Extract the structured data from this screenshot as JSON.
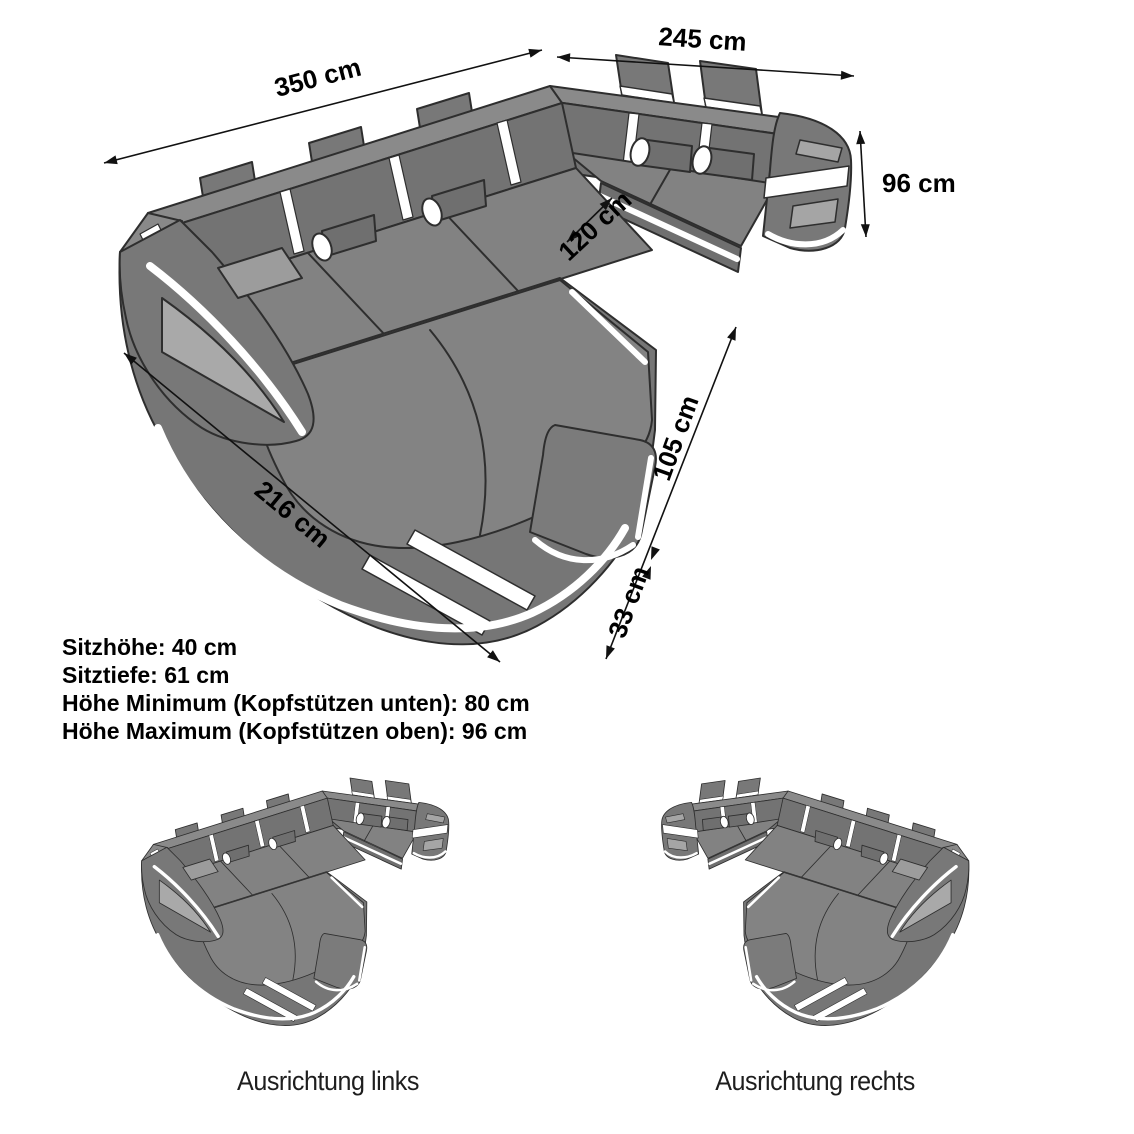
{
  "diagram": {
    "dimensions": [
      {
        "id": "back-width",
        "label": "350 cm"
      },
      {
        "id": "right-width",
        "label": "245 cm"
      },
      {
        "id": "height",
        "label": "96 cm"
      },
      {
        "id": "inner-width",
        "label": "120 cm"
      },
      {
        "id": "chaise-depth",
        "label": "105 cm"
      },
      {
        "id": "front-edge",
        "label": "33 cm"
      },
      {
        "id": "chaise-length",
        "label": "216 cm"
      }
    ],
    "specs": [
      "Sitzhöhe: 40 cm",
      "Sitztiefe: 61 cm",
      "Höhe Minimum (Kopfstützen unten): 80 cm",
      "Höhe Maximum (Kopfstützen oben): 96 cm"
    ],
    "orientations": [
      {
        "id": "links",
        "label": "Ausrichtung links"
      },
      {
        "id": "rechts",
        "label": "Ausrichtung rechts"
      }
    ],
    "colors": {
      "sofa_body": "#787878",
      "sofa_top": "#8a8a8a",
      "sofa_back_face": "#737373",
      "sofa_light_panel": "#a8a8a8",
      "accent_stripe": "#ffffff",
      "outline": "#2e2e2e",
      "dimension_line": "#111111",
      "background": "#ffffff",
      "text": "#000000"
    }
  }
}
